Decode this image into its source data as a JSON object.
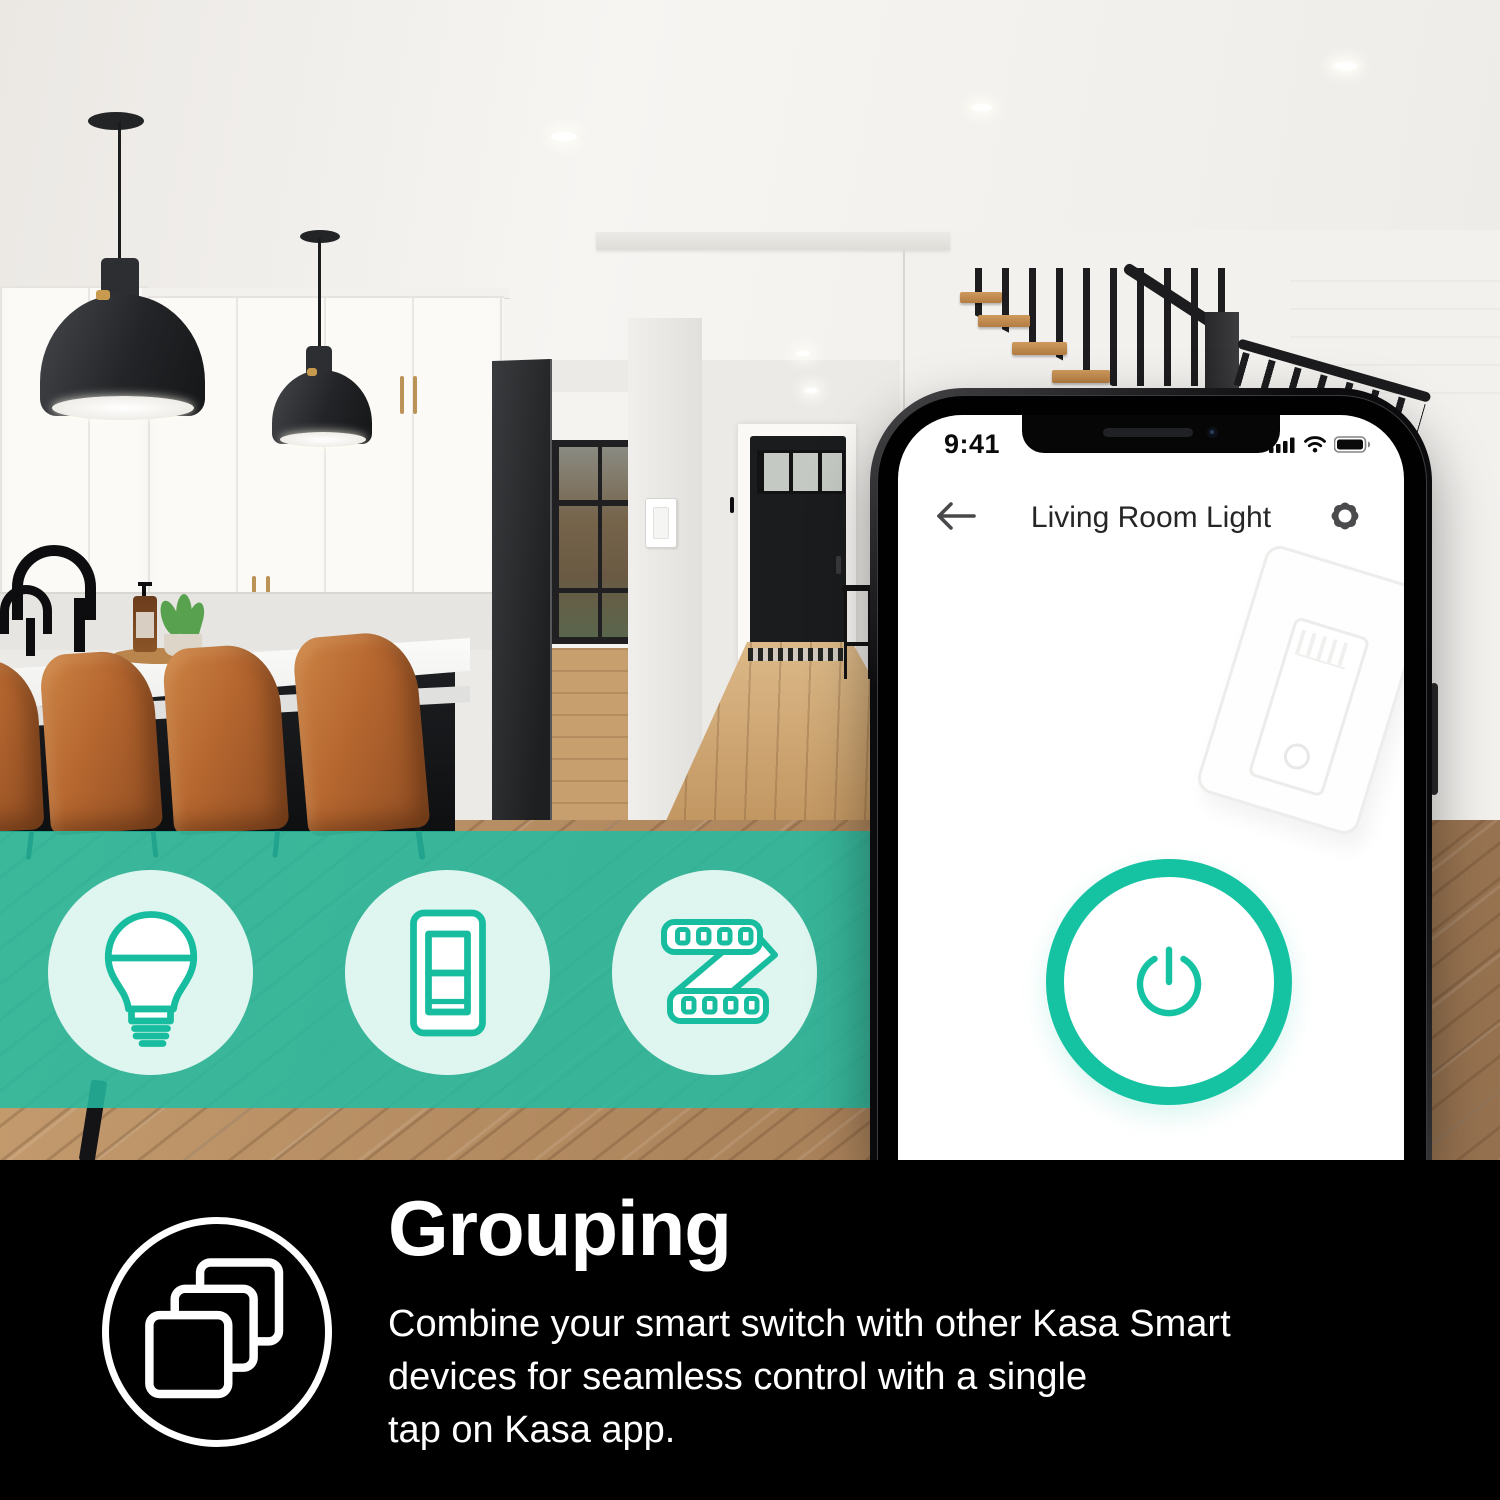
{
  "colors": {
    "accent_teal": "#15C3A2",
    "band_overlay": "#24BCA2",
    "footer_bg": "#000000",
    "phone_screen_bg": "#FFFFFF",
    "title_text": "#262626",
    "footer_text": "#FFFFFF"
  },
  "phone": {
    "status_bar": {
      "time": "9:41",
      "icons": [
        "cellular-signal-icon",
        "wifi-icon",
        "battery-icon"
      ]
    },
    "header": {
      "back_icon": "arrow-left-icon",
      "title": "Living Room Light",
      "settings_icon": "gear-icon"
    },
    "screen": {
      "illustration": "smart-wall-switch-sketch",
      "power_button_icon": "power-icon",
      "power_button_state": "off"
    }
  },
  "feature_band": {
    "icons": [
      {
        "name": "smart-bulb-icon"
      },
      {
        "name": "smart-switch-icon"
      },
      {
        "name": "led-strip-icon"
      }
    ]
  },
  "footer": {
    "icon": "grouping-layers-icon",
    "heading": "Grouping",
    "description_lines": [
      "Combine your smart switch with other Kasa Smart",
      "devices for seamless control with a single",
      "tap on Kasa app."
    ]
  }
}
